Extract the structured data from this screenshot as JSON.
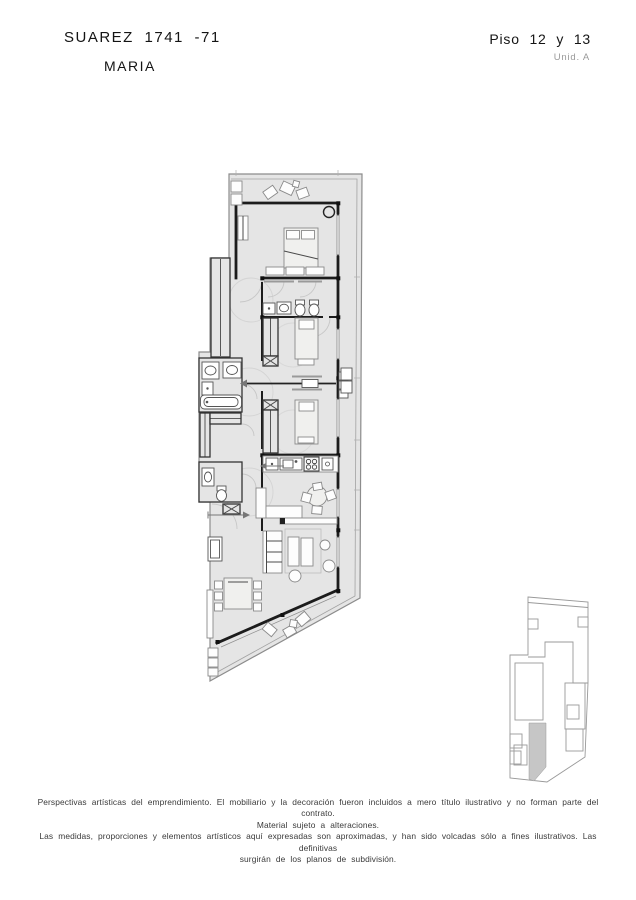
{
  "header": {
    "project": "SUAREZ 1741 -71",
    "name": "MARIA",
    "floor": "Piso 12 y 13",
    "unit": "Unid. A"
  },
  "disclaimer": {
    "line1": "Perspectivas artísticas del emprendimiento. El mobiliario y la decoración fueron incluidos a mero título ilustrativo y no forman parte del contrato.",
    "line2": "Material sujeto a alteraciones.",
    "line3": "Las medidas, proporciones y elementos artísticos aquí expresadas son aproximadas, y han sido volcadas sólo a fines ilustrativos. Las definitivas",
    "line4": "surgirán de los planos de subdivisión."
  },
  "colors": {
    "ink": "#1c1c1c",
    "plan_fill": "#e5e5e5",
    "plan_outline": "#8c8c8c",
    "furniture_stroke": "#8a8a8a",
    "muted": "#9a9a9a",
    "keyplan_highlight": "#c6c6c6"
  }
}
